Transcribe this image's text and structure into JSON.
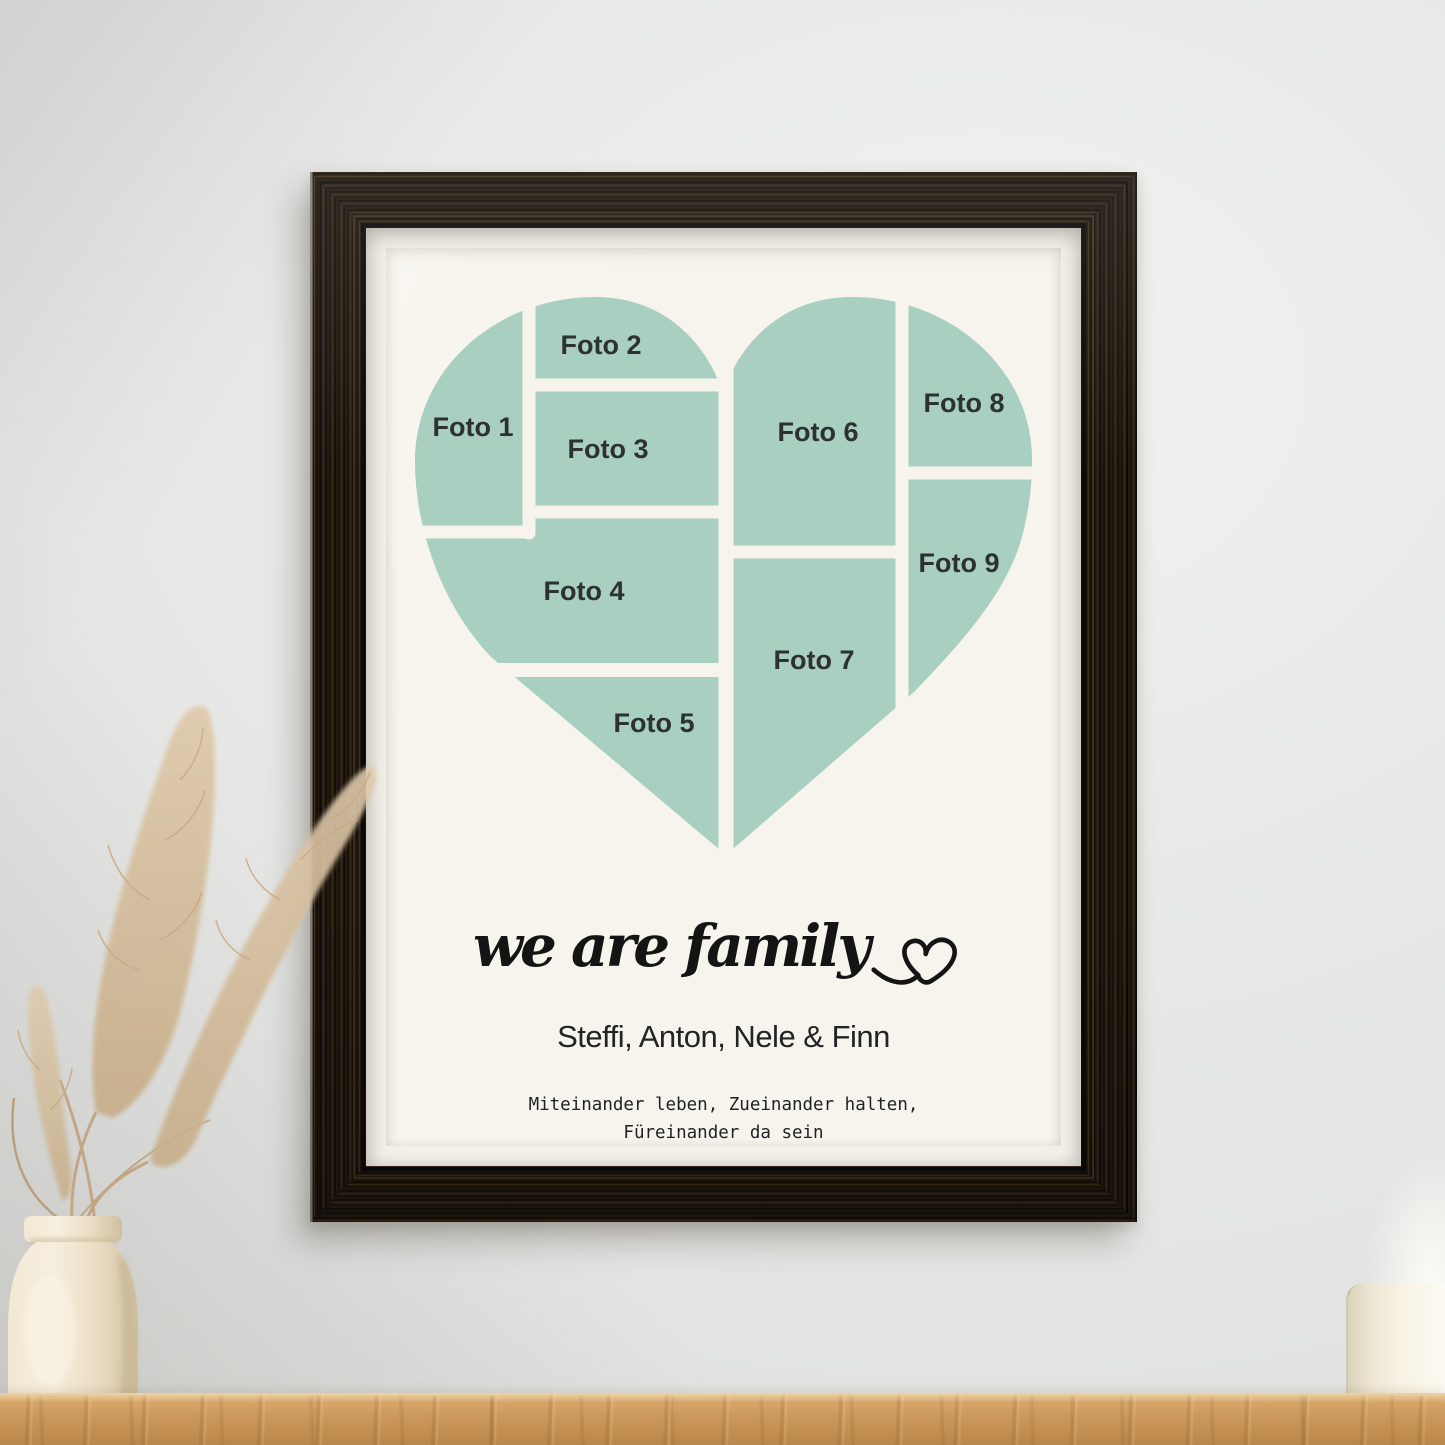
{
  "scene": {
    "wall_color": "#e9eae7",
    "shelf_wood_color": "#c9985c",
    "frame_wood_color": "#231a11",
    "vase_color": "#efe5d0",
    "pampas_color": "#d3b992",
    "candle_color": "#f3eddd"
  },
  "poster": {
    "background_color": "#f7f4ed",
    "heart_color": "#a8cfc0",
    "label_color": "#2d3133",
    "photos": [
      {
        "label": "Foto 1"
      },
      {
        "label": "Foto 2"
      },
      {
        "label": "Foto 3"
      },
      {
        "label": "Foto 4"
      },
      {
        "label": "Foto 5"
      },
      {
        "label": "Foto 6"
      },
      {
        "label": "Foto 7"
      },
      {
        "label": "Foto 8"
      },
      {
        "label": "Foto 9"
      }
    ],
    "title_script": "we are family",
    "names": "Steffi, Anton, Nele & Finn",
    "quote_line1": "Miteinander leben, Zueinander halten,",
    "quote_line2": "Füreinander da sein"
  }
}
